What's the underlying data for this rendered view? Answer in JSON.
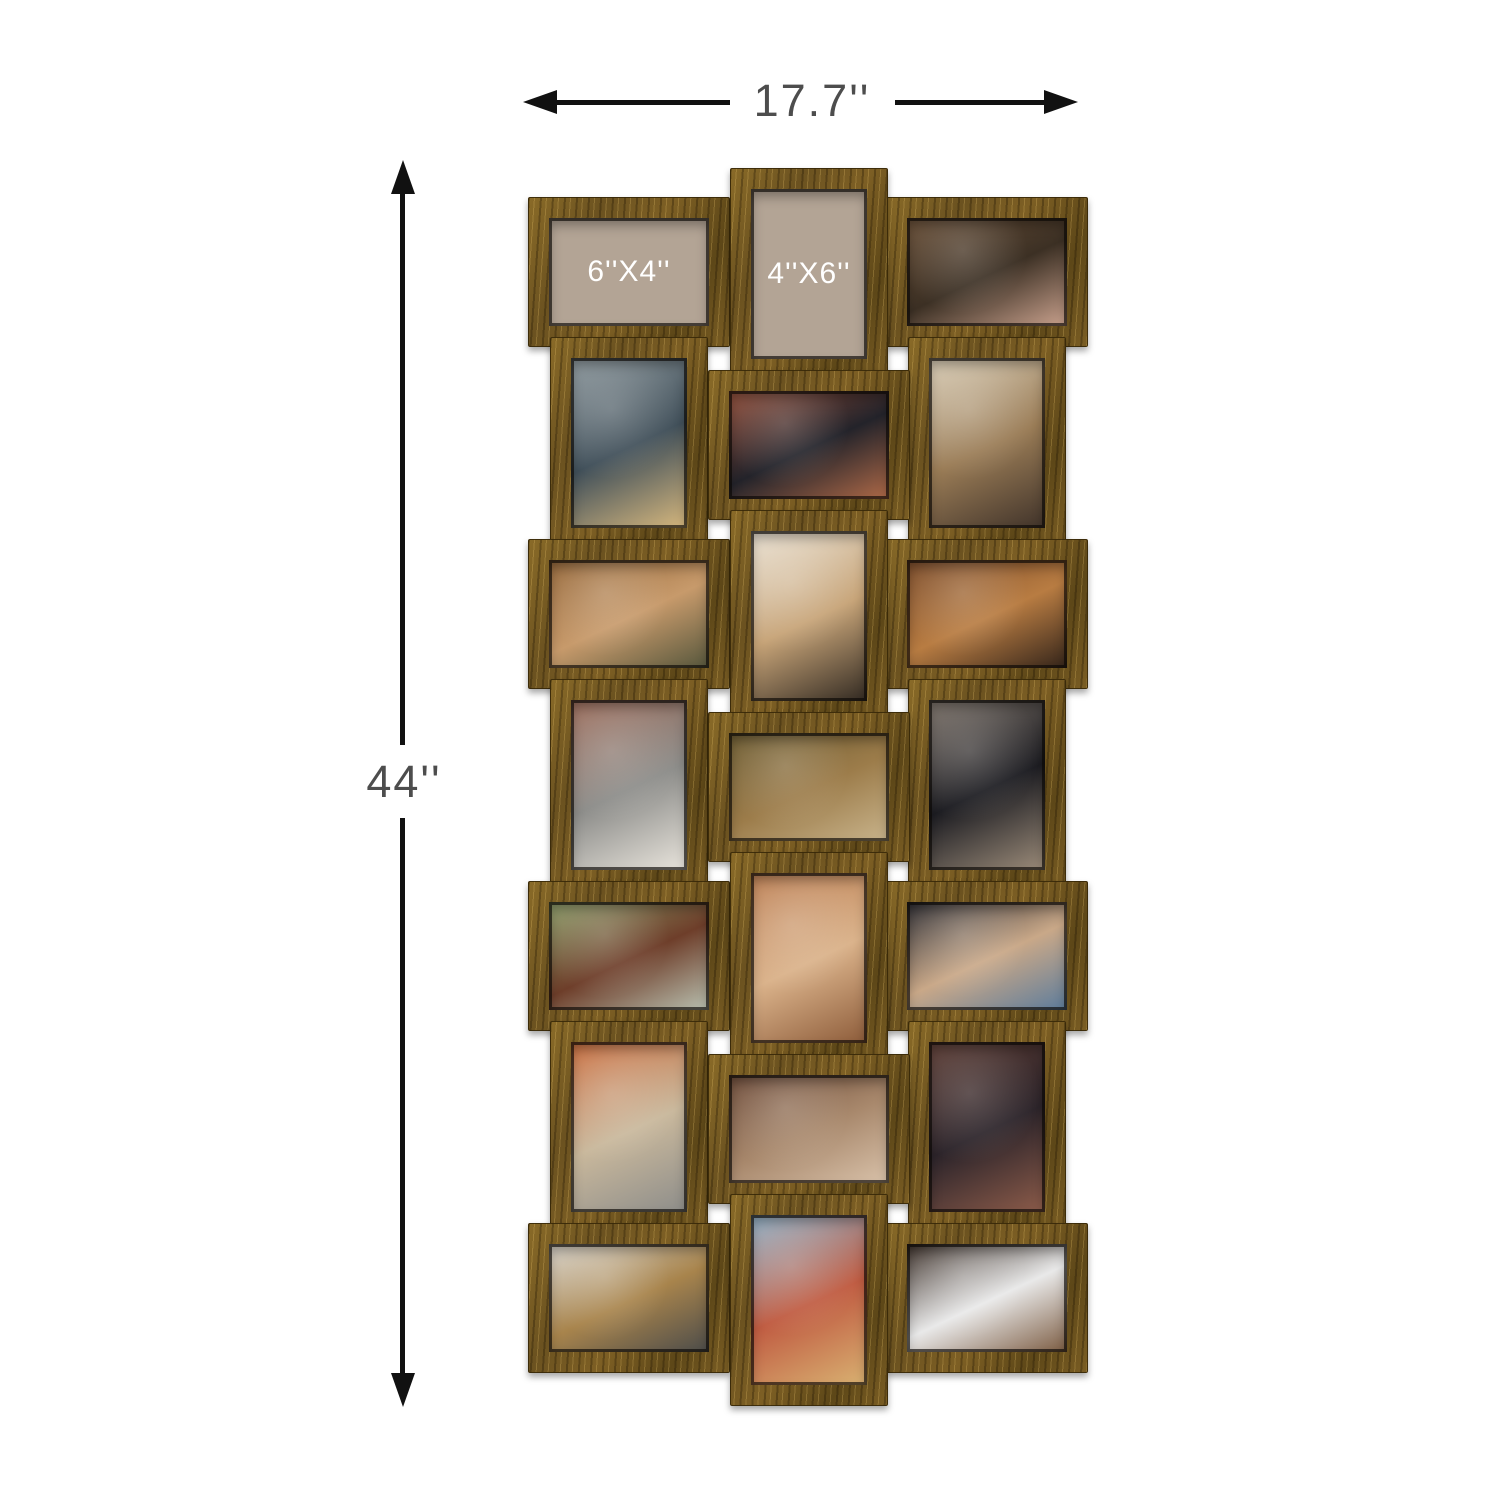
{
  "annotations": {
    "width_label": "17.7''",
    "height_label": "44''",
    "line_color": "#111111",
    "text_color": "#4d4d4d"
  },
  "product": {
    "frame_color": "#7b5e24",
    "frame_color_dark": "#5d4718",
    "frame_color_light": "#a98a3f",
    "placeholder_color": "#b3a495",
    "placeholder_text_color": "#ffffff",
    "grid": {
      "rows": 7,
      "cols": 3,
      "count": 21
    }
  },
  "frames": [
    {
      "row": 1,
      "col": 1,
      "orientation": "landscape",
      "type": "size-placeholder",
      "label": "6''X4''"
    },
    {
      "row": 1,
      "col": 2,
      "orientation": "portrait",
      "type": "size-placeholder",
      "label": "4''X6''"
    },
    {
      "row": 1,
      "col": 3,
      "orientation": "landscape",
      "type": "photo",
      "photo": "girl laughing while hugging a younger boy outdoors",
      "colors": [
        "#6a5038",
        "#3c3024",
        "#caa28e"
      ]
    },
    {
      "row": 2,
      "col": 1,
      "orientation": "portrait",
      "type": "photo",
      "photo": "woman with curly blonde hair on the phone at a laptop",
      "colors": [
        "#8d989d",
        "#41505a",
        "#d7b87e"
      ]
    },
    {
      "row": 2,
      "col": 2,
      "orientation": "landscape",
      "type": "photo",
      "photo": "man in black puffer jacket and beanie on a city street",
      "colors": [
        "#94503c",
        "#23232a",
        "#b06a48"
      ]
    },
    {
      "row": 2,
      "col": 3,
      "orientation": "portrait",
      "type": "photo",
      "photo": "woman with braids sitting on a tufted sofa with a laptop",
      "colors": [
        "#d9cdb6",
        "#9a7c56",
        "#40332a"
      ]
    },
    {
      "row": 3,
      "col": 1,
      "orientation": "landscape",
      "type": "photo",
      "photo": "two children reading a book on a couch",
      "colors": [
        "#96683a",
        "#c79a6b",
        "#55563c"
      ]
    },
    {
      "row": 3,
      "col": 2,
      "orientation": "portrait",
      "type": "photo",
      "photo": "woman with long braids seated in a rattan chair",
      "colors": [
        "#eae2d4",
        "#c7a478",
        "#322a22"
      ]
    },
    {
      "row": 3,
      "col": 3,
      "orientation": "landscape",
      "type": "photo",
      "photo": "boy and girl studying at a desk in warm light",
      "colors": [
        "#7c4c2a",
        "#b87c42",
        "#33241a"
      ]
    },
    {
      "row": 4,
      "col": 1,
      "orientation": "portrait",
      "type": "photo",
      "photo": "woman in a white hoodie walking a dog by brick steps",
      "colors": [
        "#9c6c5a",
        "#8d8d8a",
        "#e9e5dd"
      ]
    },
    {
      "row": 4,
      "col": 2,
      "orientation": "landscape",
      "type": "photo",
      "photo": "two kids drawing on a tablet on a couch",
      "colors": [
        "#6d5c32",
        "#9c7c4a",
        "#c9b48c"
      ]
    },
    {
      "row": 4,
      "col": 3,
      "orientation": "portrait",
      "type": "photo",
      "photo": "man in a black puffer jacket standing in the street",
      "colors": [
        "#7d736a",
        "#1d1d22",
        "#9c8c7a"
      ]
    },
    {
      "row": 5,
      "col": 1,
      "orientation": "landscape",
      "type": "photo",
      "photo": "wooden cabin with a green lawn and autumn trees",
      "colors": [
        "#8fa06c",
        "#6e3e2a",
        "#b9c1b1"
      ]
    },
    {
      "row": 5,
      "col": 2,
      "orientation": "portrait",
      "type": "photo",
      "photo": "eroded desert canyon rock formations",
      "colors": [
        "#bc7e52",
        "#dab28a",
        "#8d5c3a"
      ]
    },
    {
      "row": 5,
      "col": 3,
      "orientation": "landscape",
      "type": "photo",
      "photo": "woman leaning on a bed using a laptop",
      "colors": [
        "#2c2c32",
        "#c9a888",
        "#5c7c9c"
      ]
    },
    {
      "row": 6,
      "col": 1,
      "orientation": "portrait",
      "type": "photo",
      "photo": "couple walking a dog on a city sidewalk",
      "colors": [
        "#c96c3c",
        "#c9b89c",
        "#8d8d8a"
      ]
    },
    {
      "row": 6,
      "col": 2,
      "orientation": "landscape",
      "type": "photo",
      "photo": "young woman in a brown turtleneck resting her head on her hand",
      "colors": [
        "#6e4c3a",
        "#a8886c",
        "#d9c2aa"
      ]
    },
    {
      "row": 6,
      "col": 3,
      "orientation": "portrait",
      "type": "photo",
      "photo": "narrow cobblestone alley between brick buildings",
      "colors": [
        "#5c3c34",
        "#2c242a",
        "#8d5c4a"
      ]
    },
    {
      "row": 7,
      "col": 1,
      "orientation": "landscape",
      "type": "photo",
      "photo": "barista in an apron pouring milk into a glass",
      "colors": [
        "#d9d5cd",
        "#a8844c",
        "#4c4c4a"
      ]
    },
    {
      "row": 7,
      "col": 2,
      "orientation": "portrait",
      "type": "photo",
      "photo": "seaside town with red roofs above a crowded beach",
      "colors": [
        "#8fb2c9",
        "#c05c42",
        "#d9b272"
      ]
    },
    {
      "row": 7,
      "col": 3,
      "orientation": "landscape",
      "type": "photo",
      "photo": "man reclining on a bean bag with a laptop and phone",
      "colors": [
        "#3c3029",
        "#e9e9e9",
        "#7c5c42"
      ]
    }
  ]
}
